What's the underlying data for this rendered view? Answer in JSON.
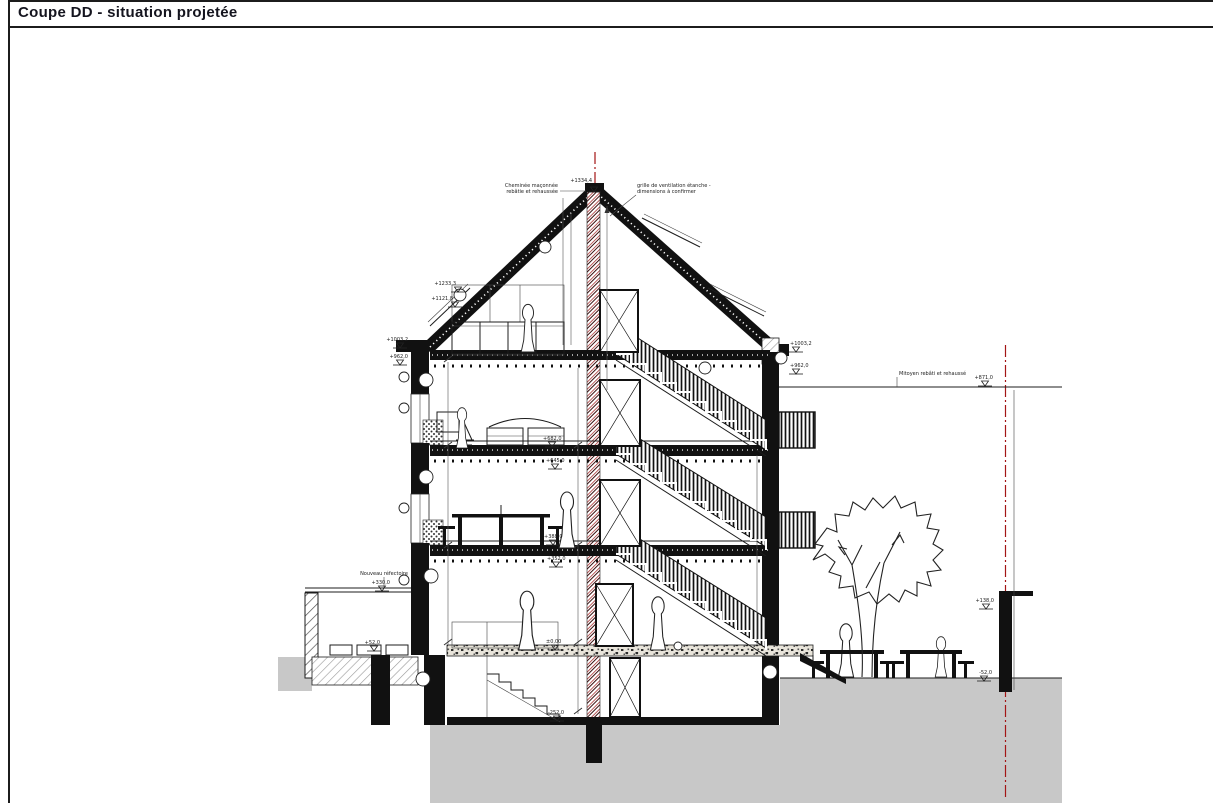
{
  "title": "Coupe DD - situation projetée",
  "drawing": {
    "labels": {
      "chimney_line1": "Cheminée maçonnée",
      "chimney_line2": "rebâtie et rehaussée",
      "grille_line1": "grille de ventilation étanche -",
      "grille_line2": "dimensions à confirmer",
      "mitoyen": "Mitoyen rebâti et rehaussé",
      "annex": "Nouveau réfectoire"
    },
    "elevations": [
      {
        "id": "ridge",
        "text": "+1334,4"
      },
      {
        "id": "roof-left-upper",
        "text": "+1233,3"
      },
      {
        "id": "roof-left-lower",
        "text": "+1121,8"
      },
      {
        "id": "eave-left-top",
        "text": "+1003,2"
      },
      {
        "id": "eave-left-bottom",
        "text": "+962,0"
      },
      {
        "id": "eave-right-top",
        "text": "+1003,2"
      },
      {
        "id": "eave-right-bottom",
        "text": "+962,0"
      },
      {
        "id": "floor2-finish",
        "text": "+682,0"
      },
      {
        "id": "floor2-struct",
        "text": "+645,0"
      },
      {
        "id": "floor1-finish",
        "text": "+388,0"
      },
      {
        "id": "floor1-struct",
        "text": "+352,0"
      },
      {
        "id": "ground",
        "text": "±0,00"
      },
      {
        "id": "basement",
        "text": "-252,0"
      },
      {
        "id": "annex-roof",
        "text": "+330,0"
      },
      {
        "id": "annex-floor",
        "text": "+52,0"
      },
      {
        "id": "mitoyen-top",
        "text": "+871,0"
      },
      {
        "id": "wall-right-top",
        "text": "+138,0"
      },
      {
        "id": "garden",
        "text": "-52,0"
      }
    ],
    "colors": {
      "line": "#1c1c1c",
      "centerline_red": "#a31515",
      "chimney_red": "#a83232",
      "ground_grey": "#c8c8c8"
    }
  }
}
